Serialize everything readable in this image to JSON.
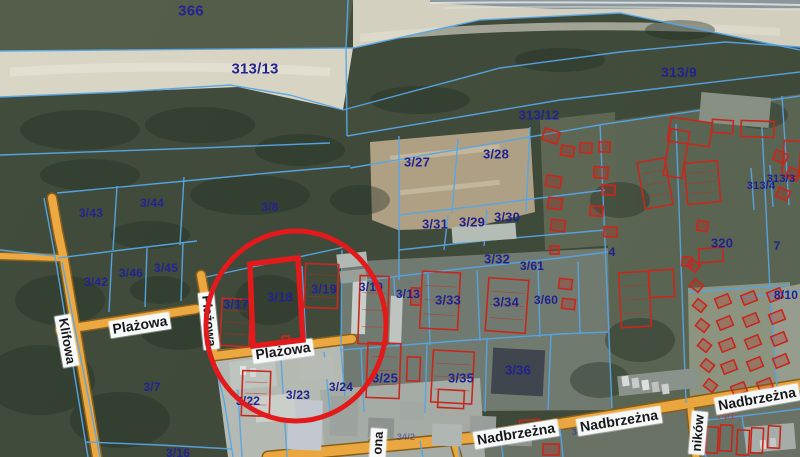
{
  "map": {
    "type": "cadastral-satellite-map",
    "highlighted_parcel": "3/18",
    "colors": {
      "parcel_line": "#56a7e8",
      "parcel_label": "#1d1d8f",
      "road_fill": "#f1a93c",
      "road_edge": "#8a5d12",
      "building_outline": "#cc2417",
      "annotation": "#e81414",
      "street_label_bg": "#ffffff",
      "street_label_text": "#111111"
    },
    "parcel_labels": [
      {
        "id": "366",
        "label": "366",
        "x": 191,
        "y": 11,
        "size": 15
      },
      {
        "id": "313/13",
        "label": "313/13",
        "x": 255,
        "y": 69,
        "size": 15
      },
      {
        "id": "313/9",
        "label": "313/9",
        "x": 679,
        "y": 72,
        "size": 14
      },
      {
        "id": "313/12",
        "label": "313/12",
        "x": 539,
        "y": 115,
        "size": 13
      },
      {
        "id": "3/27",
        "label": "3/27",
        "x": 417,
        "y": 162,
        "size": 13
      },
      {
        "id": "3/28",
        "label": "3/28",
        "x": 496,
        "y": 154,
        "size": 13
      },
      {
        "id": "3/8",
        "label": "3/8",
        "x": 270,
        "y": 207,
        "size": 12
      },
      {
        "id": "3/44",
        "label": "3/44",
        "x": 152,
        "y": 203,
        "size": 12
      },
      {
        "id": "3/43",
        "label": "3/43",
        "x": 91,
        "y": 213,
        "size": 12
      },
      {
        "id": "3/42",
        "label": "3/42",
        "x": 96,
        "y": 282,
        "size": 12
      },
      {
        "id": "3/46",
        "label": "3/46",
        "x": 131,
        "y": 273,
        "size": 12
      },
      {
        "id": "3/45",
        "label": "3/45",
        "x": 166,
        "y": 268,
        "size": 12
      },
      {
        "id": "3/31",
        "label": "3/31",
        "x": 435,
        "y": 224,
        "size": 13
      },
      {
        "id": "3/29",
        "label": "3/29",
        "x": 472,
        "y": 222,
        "size": 13
      },
      {
        "id": "3/30",
        "label": "3/30",
        "x": 507,
        "y": 217,
        "size": 13
      },
      {
        "id": "3/32",
        "label": "3/32",
        "x": 497,
        "y": 259,
        "size": 13
      },
      {
        "id": "3/61",
        "label": "3/61",
        "x": 532,
        "y": 266,
        "size": 12
      },
      {
        "id": "4",
        "label": "4",
        "x": 612,
        "y": 252,
        "size": 12
      },
      {
        "id": "320",
        "label": "320",
        "x": 722,
        "y": 243,
        "size": 13
      },
      {
        "id": "7",
        "label": "7",
        "x": 777,
        "y": 246,
        "size": 12
      },
      {
        "id": "313/4",
        "label": "313/4",
        "x": 761,
        "y": 186,
        "size": 11
      },
      {
        "id": "313/3",
        "label": "313/3",
        "x": 781,
        "y": 179,
        "size": 11
      },
      {
        "id": "8/10",
        "label": "8/10",
        "x": 786,
        "y": 295,
        "size": 12
      },
      {
        "id": "3/17",
        "label": "3/17",
        "x": 236,
        "y": 304,
        "size": 13
      },
      {
        "id": "3/18",
        "label": "3/18",
        "x": 280,
        "y": 297,
        "size": 13
      },
      {
        "id": "3/19",
        "label": "3/19",
        "x": 324,
        "y": 289,
        "size": 13
      },
      {
        "id": "3/10",
        "label": "3/10",
        "x": 371,
        "y": 287,
        "size": 12
      },
      {
        "id": "3/13",
        "label": "3/13",
        "x": 408,
        "y": 294,
        "size": 12
      },
      {
        "id": "3/33",
        "label": "3/33",
        "x": 448,
        "y": 300,
        "size": 13
      },
      {
        "id": "3/34",
        "label": "3/34",
        "x": 506,
        "y": 302,
        "size": 13
      },
      {
        "id": "3/60",
        "label": "3/60",
        "x": 546,
        "y": 300,
        "size": 12
      },
      {
        "id": "3/24",
        "label": "3/24",
        "x": 341,
        "y": 387,
        "size": 12
      },
      {
        "id": "3/25",
        "label": "3/25",
        "x": 385,
        "y": 378,
        "size": 13
      },
      {
        "id": "3/35",
        "label": "3/35",
        "x": 461,
        "y": 378,
        "size": 13
      },
      {
        "id": "3/36",
        "label": "3/36",
        "x": 518,
        "y": 370,
        "size": 13
      },
      {
        "id": "3/23",
        "label": "3/23",
        "x": 298,
        "y": 395,
        "size": 12
      },
      {
        "id": "3/22",
        "label": "3/22",
        "x": 248,
        "y": 401,
        "size": 12
      },
      {
        "id": "3/7",
        "label": "3/7",
        "x": 152,
        "y": 387,
        "size": 12
      },
      {
        "id": "3/16",
        "label": "3/16",
        "x": 178,
        "y": 453,
        "size": 12
      },
      {
        "id": "74/1",
        "label": "74/1",
        "x": 726,
        "y": 416,
        "size": 9,
        "color": "#a34848",
        "opacity": 0.9
      },
      {
        "id": "34/7",
        "label": "34/7",
        "x": 581,
        "y": 432,
        "size": 9,
        "opacity": 0.5
      },
      {
        "id": "34/2",
        "label": "34/2",
        "x": 406,
        "y": 437,
        "size": 9,
        "opacity": 0.45
      }
    ],
    "street_labels": [
      {
        "name": "Klifowa",
        "x": 67,
        "y": 341,
        "rotation": 80,
        "size": 13
      },
      {
        "name": "Plażowa",
        "x": 140,
        "y": 325,
        "rotation": -9,
        "size": 14
      },
      {
        "name": "Plażowa",
        "x": 209,
        "y": 321,
        "rotation": 84,
        "size": 13
      },
      {
        "name": "Plażowa",
        "x": 283,
        "y": 351,
        "rotation": -8,
        "size": 14
      },
      {
        "name": "Nadbrzeżna",
        "x": 516,
        "y": 434,
        "rotation": -9,
        "size": 14
      },
      {
        "name": "Nadbrzeżna",
        "x": 619,
        "y": 421,
        "rotation": -9,
        "size": 14
      },
      {
        "name": "Nadbrzeżna",
        "x": 757,
        "y": 399,
        "rotation": -10,
        "size": 14
      },
      {
        "name": "ników",
        "x": 698,
        "y": 433,
        "rotation": -85,
        "size": 13
      },
      {
        "name": "ona",
        "x": 378,
        "y": 443,
        "rotation": -86,
        "size": 13
      }
    ],
    "red_buildings": [
      [
        641,
        160,
        28,
        47,
        -10
      ],
      [
        686,
        162,
        33,
        41,
        -5
      ],
      [
        669,
        120,
        42,
        24,
        8
      ],
      [
        667,
        130,
        19,
        47,
        10
      ],
      [
        712,
        120,
        21,
        13,
        4
      ],
      [
        741,
        121,
        33,
        16,
        2
      ],
      [
        783,
        141,
        17,
        35,
        4
      ],
      [
        221,
        299,
        29,
        47,
        3
      ],
      [
        305,
        264,
        33,
        44,
        2
      ],
      [
        242,
        371,
        28,
        45,
        2
      ],
      [
        359,
        276,
        29,
        68,
        2
      ],
      [
        421,
        272,
        38,
        57,
        3
      ],
      [
        487,
        279,
        40,
        53,
        4
      ],
      [
        432,
        351,
        41,
        52,
        3
      ],
      [
        367,
        343,
        33,
        55,
        2
      ],
      [
        620,
        272,
        30,
        55,
        -3
      ],
      [
        649,
        270,
        25,
        27,
        -3
      ],
      [
        543,
        130,
        16,
        12,
        18
      ],
      [
        561,
        146,
        13,
        10,
        10
      ],
      [
        580,
        143,
        12,
        10,
        4
      ],
      [
        599,
        142,
        11,
        10,
        2
      ],
      [
        546,
        176,
        15,
        11,
        8
      ],
      [
        548,
        198,
        14,
        11,
        6
      ],
      [
        551,
        220,
        14,
        11,
        6
      ],
      [
        594,
        167,
        14,
        11,
        4
      ],
      [
        602,
        185,
        13,
        10,
        4
      ],
      [
        590,
        206,
        13,
        10,
        4
      ],
      [
        604,
        227,
        13,
        10,
        4
      ],
      [
        559,
        279,
        13,
        10,
        6
      ],
      [
        562,
        299,
        13,
        10,
        6
      ],
      [
        550,
        246,
        9,
        8,
        0
      ],
      [
        774,
        152,
        13,
        10,
        24
      ],
      [
        787,
        169,
        12,
        10,
        24
      ],
      [
        777,
        189,
        12,
        10,
        24
      ],
      [
        697,
        221,
        11,
        10,
        8
      ],
      [
        699,
        248,
        24,
        14,
        -4
      ],
      [
        682,
        257,
        10,
        9,
        4
      ],
      [
        688,
        261,
        11,
        9,
        38
      ],
      [
        691,
        281,
        11,
        9,
        38
      ],
      [
        694,
        301,
        11,
        9,
        38
      ],
      [
        697,
        321,
        11,
        9,
        38
      ],
      [
        699,
        341,
        11,
        9,
        38
      ],
      [
        702,
        361,
        11,
        9,
        38
      ],
      [
        705,
        381,
        11,
        9,
        38
      ],
      [
        716,
        296,
        14,
        10,
        -22
      ],
      [
        742,
        293,
        14,
        10,
        -22
      ],
      [
        768,
        290,
        14,
        10,
        -22
      ],
      [
        718,
        318,
        14,
        10,
        -22
      ],
      [
        744,
        315,
        14,
        10,
        -22
      ],
      [
        770,
        312,
        14,
        10,
        -22
      ],
      [
        720,
        340,
        14,
        10,
        -22
      ],
      [
        746,
        337,
        14,
        10,
        -22
      ],
      [
        772,
        334,
        14,
        10,
        -22
      ],
      [
        722,
        362,
        14,
        10,
        -22
      ],
      [
        748,
        359,
        14,
        10,
        -22
      ],
      [
        774,
        356,
        14,
        10,
        -22
      ],
      [
        732,
        384,
        14,
        10,
        -22
      ],
      [
        758,
        380,
        14,
        10,
        -22
      ],
      [
        282,
        336,
        7,
        7,
        0
      ],
      [
        438,
        390,
        26,
        18,
        3
      ],
      [
        520,
        420,
        20,
        15,
        -4
      ],
      [
        543,
        444,
        16,
        11,
        0
      ],
      [
        407,
        357,
        13,
        24,
        2
      ],
      [
        411,
        288,
        10,
        17,
        2
      ],
      [
        706,
        427,
        12,
        26,
        3
      ],
      [
        720,
        425,
        12,
        26,
        3
      ],
      [
        737,
        430,
        12,
        25,
        3
      ],
      [
        751,
        428,
        12,
        25,
        3
      ],
      [
        768,
        426,
        12,
        22,
        3
      ]
    ],
    "gray_roofs": [
      [
        288,
        400,
        34,
        50,
        2,
        "#c7ccd3"
      ],
      [
        492,
        349,
        52,
        46,
        3,
        "#3d434b"
      ],
      [
        352,
        276,
        14,
        58,
        2,
        "#cdd2cc"
      ],
      [
        390,
        296,
        12,
        48,
        2,
        "#c3c8c2"
      ],
      [
        452,
        225,
        64,
        16,
        -4,
        "#b8bfb8"
      ],
      [
        337,
        253,
        30,
        14,
        -6,
        "#b5bbb5"
      ],
      [
        340,
        270,
        26,
        12,
        -6,
        "#9aa19a"
      ],
      [
        230,
        360,
        46,
        28,
        -5,
        "#c2c7c0"
      ],
      [
        255,
        395,
        40,
        26,
        -5,
        "#cfd3cd"
      ],
      [
        300,
        358,
        34,
        22,
        -5,
        "#b9beb8"
      ],
      [
        330,
        396,
        28,
        40,
        2,
        "#9fa5a0"
      ],
      [
        368,
        418,
        26,
        20,
        2,
        "#8f9590"
      ],
      [
        400,
        402,
        24,
        18,
        2,
        "#a5aaa4"
      ],
      [
        432,
        424,
        30,
        22,
        2,
        "#b4b9b3"
      ],
      [
        470,
        416,
        26,
        18,
        2,
        "#9ba19b"
      ],
      [
        508,
        430,
        24,
        16,
        2,
        "#8f9590"
      ],
      [
        700,
        95,
        70,
        30,
        5,
        "#8a9284"
      ],
      [
        618,
        372,
        80,
        20,
        -6,
        "#8d948d"
      ],
      [
        745,
        425,
        50,
        26,
        -5,
        "#aab0aa"
      ],
      [
        240,
        366,
        6,
        9,
        0,
        "#e8eae8"
      ],
      [
        250,
        368,
        6,
        9,
        0,
        "#d8dad8"
      ],
      [
        262,
        366,
        6,
        9,
        0,
        "#c8cac8"
      ],
      [
        622,
        376,
        7,
        10,
        -8,
        "#dfe1df"
      ],
      [
        632,
        378,
        7,
        10,
        -8,
        "#cfd1cf"
      ],
      [
        642,
        380,
        7,
        10,
        -8,
        "#e4e6e4"
      ],
      [
        652,
        382,
        7,
        10,
        -8,
        "#c4c6c4"
      ],
      [
        662,
        384,
        7,
        10,
        -8,
        "#d4d6d4"
      ],
      [
        760,
        440,
        6,
        9,
        -5,
        "#dddddd"
      ],
      [
        770,
        438,
        6,
        9,
        -5,
        "#cccccc"
      ]
    ],
    "annotation": {
      "circle": {
        "cx": 296,
        "cy": 326,
        "rx": 90,
        "ry": 95
      },
      "parcel_outline_points": "250,264 298,258 303,340 253,346"
    }
  }
}
